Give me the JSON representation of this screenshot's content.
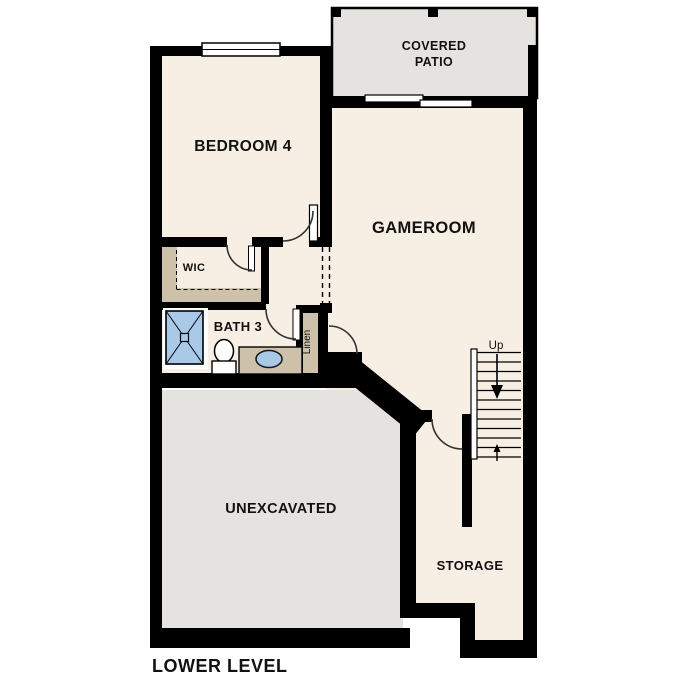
{
  "plan_title": "LOWER LEVEL",
  "colors": {
    "floor": "#f7efe3",
    "outdoor_area": "#e4e3e0",
    "wall": "#000000",
    "casework_tan": "#cdc1a9",
    "fixture_blue": "#a9c9e9",
    "background": "#ffffff",
    "text": "#111111"
  },
  "rooms": {
    "covered_patio": {
      "label_line1": "COVERED",
      "label_line2": "PATIO"
    },
    "bedroom4": {
      "label": "BEDROOM 4"
    },
    "gameroom": {
      "label": "GAMEROOM"
    },
    "wic": {
      "label": "WIC"
    },
    "bath3": {
      "label": "BATH 3"
    },
    "linen": {
      "label": "Linen"
    },
    "unexcavated": {
      "label": "UNEXCAVATED"
    },
    "storage": {
      "label": "STORAGE"
    }
  },
  "stairs": {
    "direction_label": "Up"
  },
  "fixtures": {
    "shower": "shower",
    "toilet": "toilet",
    "vanity_sink": "vanity-sink"
  }
}
